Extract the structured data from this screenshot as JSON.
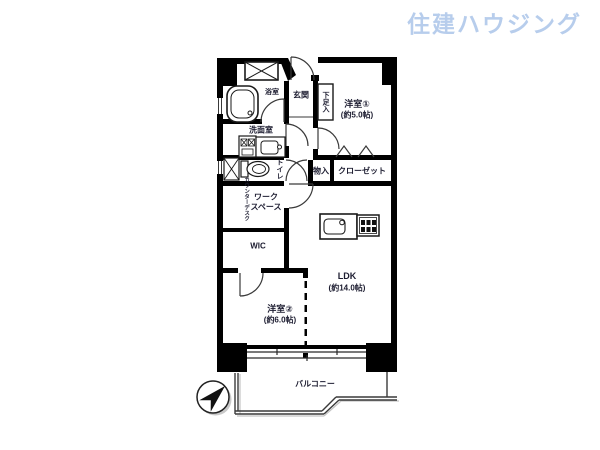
{
  "logo": {
    "text": "住建ハウジング",
    "color": "#b7cdec"
  },
  "plan": {
    "rooms": {
      "western1": {
        "name": "洋室①",
        "size": "(約5.0帖)"
      },
      "western2": {
        "name": "洋室②",
        "size": "(約6.0帖)"
      },
      "ldk": {
        "name": "LDK",
        "size": "(約14.0帖)"
      },
      "entrance": {
        "name": "玄関"
      },
      "bathroom": {
        "name": "浴室"
      },
      "washroom": {
        "name": "洗面室"
      },
      "toilet": {
        "name": "トイレ"
      },
      "storage": {
        "name": "物入"
      },
      "closet": {
        "name": "クローゼット"
      },
      "shoe_cabinet": {
        "name": "下足入"
      },
      "workspace": {
        "line1": "ワーク",
        "line2": "スペース"
      },
      "counter_desk": {
        "name": "カウンターデスク"
      },
      "wic": {
        "name": "WIC"
      },
      "balcony": {
        "name": "バルコニー"
      }
    },
    "icons": {
      "compass-icon": "north arrow in circle pointing upper-right",
      "pipe-space-icon": "box with X cross",
      "bathtub-icon": "rounded bathtub outline",
      "washing-machine-icon": "box with crossed squares",
      "vanity-icon": "washstand with basin",
      "toilet-icon": "toilet bowl with tank",
      "kitchen-sink-icon": "counter with sink and faucet",
      "stove-icon": "box with burner grid",
      "door-swing-icon": "quarter-circle door arc",
      "bifold-door-icon": "zigzag closet door marks"
    },
    "colors": {
      "wall": "#000000",
      "line": "#3a3a3a",
      "shadow": "#c4c4c4"
    }
  }
}
